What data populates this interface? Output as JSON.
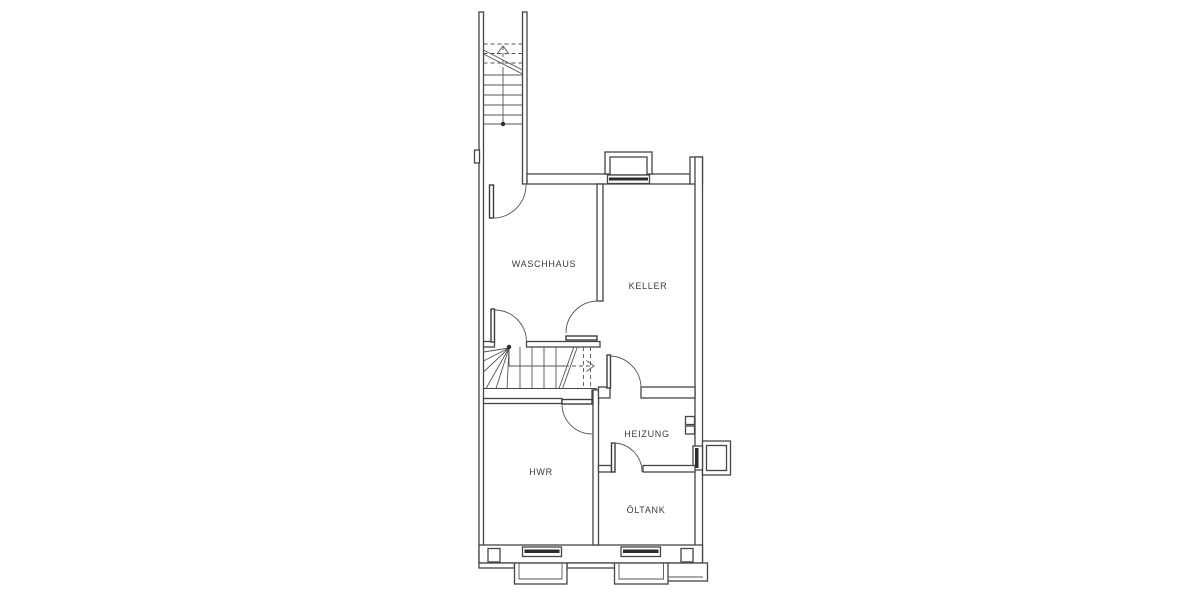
{
  "page": {
    "background_color": "#ffffff",
    "kind": "architectural basement floor plan"
  },
  "floorplan": {
    "line_color": "#454545",
    "label_color": "#3a3a3a",
    "rooms": [
      {
        "name": "waschhaus",
        "label": "WASCHHAUS"
      },
      {
        "name": "keller",
        "label": "KELLER"
      },
      {
        "name": "heizung",
        "label": "HEIZUNG"
      },
      {
        "name": "hwr",
        "label": "HWR"
      },
      {
        "name": "oeltank",
        "label": "ÖLTANK"
      }
    ],
    "features": [
      "exterior-staircase-icon",
      "interior-winder-staircase-icon",
      "door-swing-icon",
      "window-icon",
      "light-well-icon",
      "wall-mounted-box-icon"
    ]
  }
}
